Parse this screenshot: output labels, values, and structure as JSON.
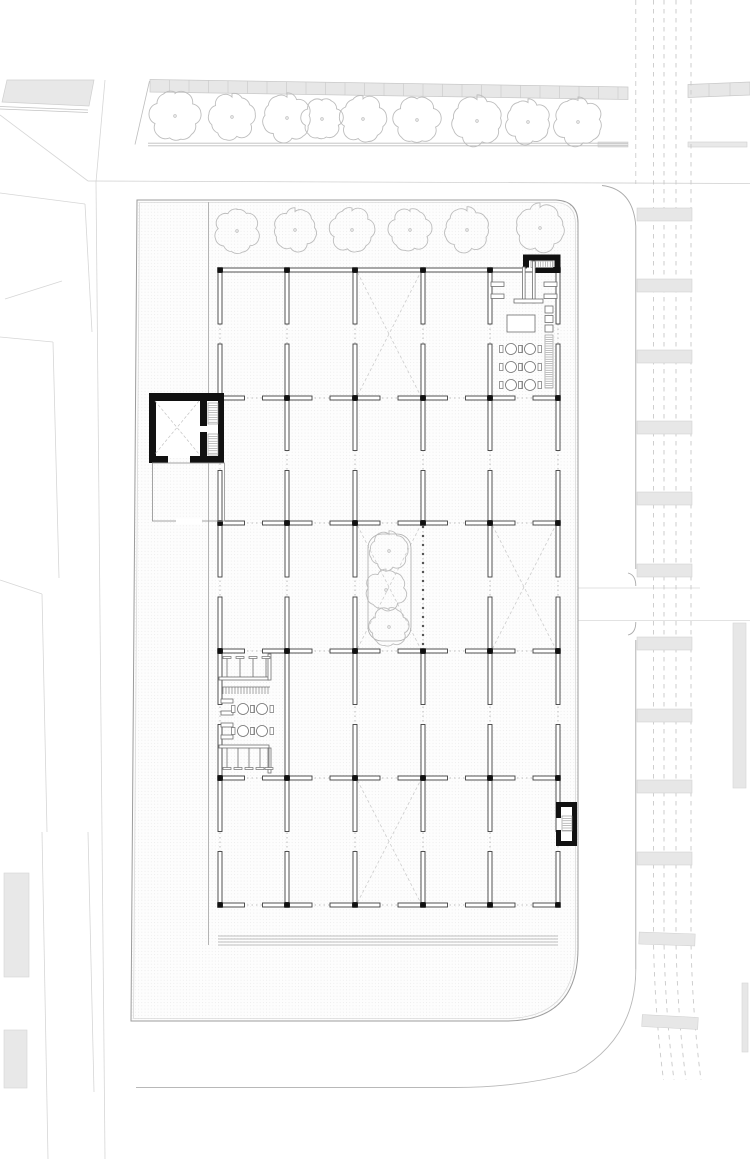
{
  "meta": {
    "title": "Architectural site plan - ground floor with column grid, stair cores and street context",
    "canvas": {
      "w": 750,
      "h": 1159
    }
  },
  "palette": {
    "paper": "#ffffff",
    "black_core": "#111111",
    "wall_stroke": "#3f3f3f",
    "furniture_stroke": "#6e6e6e",
    "tree_stroke": "#bdbdbd",
    "brace_stroke": "#cccccc",
    "dotted_grid": "#ababab",
    "terrace_stroke": "#9c9c9c",
    "terrace_inner": "#d9d9d9",
    "faint_street": "#d6d6d6",
    "road_edge": "#ababab",
    "lane_dash": "#c9c9c9",
    "block_fill": "#e8e8e8",
    "bar_fill": "#e7e7e7",
    "bar_stroke": "#d2d2d2",
    "stipple_dot": "#e6e6e6",
    "hatch_stroke": "#8a8a8a"
  },
  "plan": {
    "streets": {
      "faint_lines": [
        [
          0,
          115,
          88,
          181
        ],
        [
          105,
          80,
          96,
          182
        ],
        [
          0,
          193,
          85,
          204
        ],
        [
          96,
          182,
          105,
          1159
        ],
        [
          85,
          204,
          92,
          332
        ],
        [
          0,
          337,
          53,
          342
        ],
        [
          53,
          342,
          59,
          578
        ],
        [
          0,
          580,
          42,
          594
        ],
        [
          42,
          594,
          47,
          832
        ],
        [
          42,
          832,
          48,
          1159
        ],
        [
          88,
          832,
          94,
          1092
        ],
        [
          5,
          299,
          62,
          281
        ]
      ],
      "nw_block": {
        "pts": [
          [
            7,
            80
          ],
          [
            94,
            80
          ],
          [
            89,
            106
          ],
          [
            2,
            102
          ]
        ]
      },
      "nw_block_edge": [
        [
          0,
          106.5,
          88,
          110
        ],
        [
          0,
          109,
          88,
          112.5
        ]
      ],
      "west_rects": [
        {
          "x": 4,
          "y": 873,
          "w": 25,
          "h": 104
        },
        {
          "x": 4,
          "y": 1030,
          "w": 23,
          "h": 58
        }
      ],
      "north_line": [
        88,
        181,
        750,
        183.5
      ],
      "bands": [
        {
          "x1": 150,
          "y1": 79.5,
          "x2": 628,
          "y2": 87,
          "h": 12.5,
          "step": 19.5
        },
        {
          "x1": 688,
          "y1": 84.5,
          "x2": 750,
          "y2": 82,
          "h": 13,
          "step": 21
        }
      ],
      "thin_bars": [
        {
          "x": 598,
          "y": 142,
          "w": 30,
          "h": 5
        },
        {
          "x": 688,
          "y": 142,
          "w": 59,
          "h": 5
        }
      ],
      "tree_strip_bottom": [
        [
          148,
          143.2,
          628,
          143.2
        ],
        [
          148,
          145.8,
          628,
          145.8
        ]
      ],
      "tree_strip_left_edge": [
        149.5,
        81,
        135,
        144.5
      ]
    },
    "road": {
      "top_corner": "M602,185.5 Q633,189 635.8,226",
      "edge_segments": [
        [
          635.8,
          226,
          635.8,
          569
        ],
        [
          635.8,
          640,
          635.8,
          969
        ]
      ],
      "edge_dashed_top": [
        635.8,
        0,
        635.8,
        184
      ],
      "driveway_brackets": [
        "M628,573 Q635.8,575 635.8,586",
        "M628,635 Q635.8,633 635.8,622"
      ],
      "driveway_lines": [
        [
          578,
          588,
          700,
          588
        ],
        [
          578,
          620.5,
          750,
          620.5
        ]
      ],
      "outer_bottom": "M635.8,969 Q635.8,1038 576,1072 Q521,1087.5 455,1087.5 L136,1087.5",
      "lane_xs": [
        653.5,
        664,
        676,
        691
      ],
      "lane_path_suffix": " L0,943 Q1.5,1015 10,1080",
      "crosswalk": {
        "x": 637,
        "w": 55,
        "h": 13,
        "ys": [
          208,
          279,
          350,
          421,
          492,
          564,
          637,
          709,
          780,
          852
        ]
      },
      "crosswalk_tilted": [
        {
          "x": 639,
          "y": 933,
          "w": 56,
          "h": 12,
          "rot": 2,
          "cx": 667,
          "cy": 939
        },
        {
          "x": 642,
          "y": 1016,
          "w": 56,
          "h": 12,
          "rot": 3,
          "cx": 670,
          "cy": 1022
        }
      ],
      "right_strips": [
        {
          "x": 733,
          "y": 623,
          "w": 13,
          "h": 165
        },
        {
          "x": 742,
          "y": 983,
          "w": 6,
          "h": 69
        }
      ]
    },
    "site": {
      "parcel_path": "M137,200 L556,200 Q578,201 578,223 L578,948 Q578,1021 506,1021 L131,1021 Z",
      "parcel_inner_path": "M139.5,202.5 L555,202.5 Q575.5,203 575.5,224 L575.5,947 Q575.5,1018.5 505,1018.5 L133.5,1018.5 Z",
      "south_steps": [
        [
          218,
          936,
          558,
          936
        ],
        [
          218,
          939,
          558,
          939
        ],
        [
          218,
          942,
          558,
          942
        ],
        [
          218,
          945,
          558,
          945
        ]
      ],
      "canopy_line": [
        208.5,
        202,
        208.5,
        945
      ]
    },
    "trees": {
      "row_a": [
        [
          175,
          116,
          27
        ],
        [
          232,
          117,
          25
        ],
        [
          287,
          118,
          26
        ],
        [
          322,
          119,
          22
        ],
        [
          363,
          119,
          25
        ],
        [
          417,
          120,
          25
        ],
        [
          477,
          121,
          27
        ],
        [
          528,
          122,
          24
        ],
        [
          578,
          122,
          26
        ]
      ],
      "row_b": [
        [
          237,
          231,
          24
        ],
        [
          295,
          230,
          23
        ],
        [
          352,
          230,
          24
        ],
        [
          410,
          230,
          23
        ],
        [
          467,
          230,
          24
        ],
        [
          540,
          228,
          26
        ]
      ],
      "atrium": [
        [
          389,
          551,
          21
        ],
        [
          386,
          590,
          22
        ],
        [
          389,
          627,
          21
        ]
      ]
    },
    "building": {
      "cols": [
        220,
        287,
        355,
        423,
        490,
        558
      ],
      "rows": [
        270,
        398,
        523,
        651,
        778,
        905
      ],
      "wall_thickness": 4,
      "end_margin": 2.5,
      "gap_h": 18,
      "gap_v": 20,
      "column_size": 5.5,
      "top_row_solid": true,
      "solid_vertical": [
        {
          "c": 1,
          "r": 3
        }
      ],
      "open_vertical": [
        {
          "c": 3,
          "r": 2
        }
      ],
      "braces": [
        [
          357.5,
          272.5,
          420.5,
          395.5
        ],
        [
          357.5,
          525.5,
          420.5,
          648.5
        ],
        [
          492.5,
          525.5,
          555.5,
          648.5
        ],
        [
          357.5,
          780.5,
          420.5,
          902.5
        ]
      ],
      "tickline": {
        "x": 423,
        "y1": 527,
        "y2": 648,
        "step": 9
      },
      "planter": {
        "x": 368,
        "y": 534,
        "w": 43,
        "h": 107,
        "rx": 14
      }
    },
    "west_core": {
      "solids": [
        {
          "x": 149,
          "y": 393,
          "w": 75,
          "h": 8
        },
        {
          "x": 149,
          "y": 393,
          "w": 7,
          "h": 70
        },
        {
          "x": 149,
          "y": 456,
          "w": 19,
          "h": 7
        },
        {
          "x": 190,
          "y": 456,
          "w": 34,
          "h": 7
        },
        {
          "x": 200,
          "y": 398,
          "w": 7,
          "h": 28
        },
        {
          "x": 200,
          "y": 432,
          "w": 7,
          "h": 26
        },
        {
          "x": 218,
          "y": 393,
          "w": 6,
          "h": 70
        }
      ],
      "hatches": [
        {
          "x": 208,
          "y": 403,
          "w": 10,
          "h": 21,
          "step": 2.4,
          "dir": "h"
        },
        {
          "x": 208,
          "y": 434,
          "w": 10,
          "h": 21,
          "step": 2.4,
          "dir": "h"
        }
      ],
      "x_lines": [
        [
          155,
          401,
          199,
          454
        ],
        [
          199,
          401,
          155,
          454
        ]
      ],
      "room": {
        "x": 152.5,
        "y": 463,
        "w": 72,
        "h": 58
      },
      "room_door_gap": {
        "x": 176,
        "y": 518.5,
        "w": 26,
        "h": 6
      }
    },
    "ne_core": {
      "solids": [
        {
          "x": 523,
          "y": 254.5,
          "w": 37,
          "h": 6
        },
        {
          "x": 554.5,
          "y": 254.5,
          "w": 6,
          "h": 18
        },
        {
          "x": 533,
          "y": 267,
          "w": 27.5,
          "h": 6
        },
        {
          "x": 523,
          "y": 254.5,
          "w": 6,
          "h": 13
        }
      ],
      "hatch": {
        "x": 531,
        "y": 261,
        "w": 22,
        "h": 6.5,
        "step": 2.4,
        "dir": "v"
      },
      "corridor_walls": [
        {
          "x": 522.5,
          "y": 267,
          "w": 2.6,
          "h": 36
        },
        {
          "x": 532.5,
          "y": 261,
          "w": 2.6,
          "h": 42
        }
      ],
      "partition": {
        "x": 514,
        "y": 299,
        "w": 29,
        "h": 4
      }
    },
    "east_core": {
      "solids": [
        {
          "x": 556,
          "y": 802,
          "w": 21,
          "h": 5
        },
        {
          "x": 572,
          "y": 802,
          "w": 5,
          "h": 44
        },
        {
          "x": 556,
          "y": 841,
          "w": 21,
          "h": 5
        },
        {
          "x": 556,
          "y": 802,
          "w": 5,
          "h": 16
        },
        {
          "x": 556,
          "y": 830,
          "w": 5,
          "h": 16
        }
      ],
      "hatch": {
        "x": 562,
        "y": 816,
        "w": 10,
        "h": 15,
        "step": 2.4,
        "dir": "h"
      }
    },
    "cafe_furniture": {
      "wall_stubs": [
        {
          "x": 491,
          "y": 282,
          "w": 13,
          "h": 4.5
        },
        {
          "x": 491,
          "y": 294,
          "w": 13,
          "h": 4.5
        },
        {
          "x": 544,
          "y": 282,
          "w": 13,
          "h": 4.5
        },
        {
          "x": 544,
          "y": 294,
          "w": 13,
          "h": 4.5
        }
      ],
      "square_table": {
        "x": 507,
        "y": 315,
        "w": 28,
        "h": 17
      },
      "round_tables": [
        [
          511,
          349
        ],
        [
          530,
          349
        ],
        [
          511,
          367
        ],
        [
          530,
          367
        ],
        [
          511,
          385
        ],
        [
          530,
          385
        ]
      ],
      "table_radius": 5.5,
      "wall_boxes": [
        {
          "x": 545,
          "y": 306,
          "w": 8,
          "h": 7
        },
        {
          "x": 545,
          "y": 315.5,
          "w": 8,
          "h": 7
        },
        {
          "x": 545,
          "y": 325,
          "w": 8,
          "h": 7
        }
      ],
      "shelf_strip": {
        "x": 545,
        "y": 335,
        "w": 8,
        "h": 53,
        "step": 2.2,
        "dir": "h"
      }
    },
    "west_zone": {
      "top_counter": [
        {
          "x": 219,
          "y": 677,
          "w": 50,
          "h": 3
        },
        {
          "x": 268,
          "y": 654,
          "w": 3,
          "h": 26
        }
      ],
      "top_stools": {
        "xs": [
          227,
          240,
          253,
          266
        ],
        "y1": 658,
        "y2": 677,
        "bar": "top"
      },
      "comb": {
        "x1": 222,
        "x2": 270,
        "y": 687,
        "step": 3,
        "len": 7
      },
      "benches": [
        {
          "x": 221,
          "y": 699,
          "w": 12,
          "h": 4
        },
        {
          "x": 221,
          "y": 711,
          "w": 12,
          "h": 4
        },
        {
          "x": 221,
          "y": 723,
          "w": 12,
          "h": 4
        },
        {
          "x": 221,
          "y": 735,
          "w": 12,
          "h": 4
        }
      ],
      "round_tables": [
        [
          243,
          709
        ],
        [
          262,
          709
        ],
        [
          243,
          731
        ],
        [
          262,
          731
        ]
      ],
      "table_radius": 5.5,
      "bottom_counter": [
        {
          "x": 219,
          "y": 745,
          "w": 50,
          "h": 3
        },
        {
          "x": 268,
          "y": 748,
          "w": 3,
          "h": 25
        }
      ],
      "bottom_stools": {
        "xs": [
          227,
          238,
          249,
          260,
          269
        ],
        "y1": 748,
        "y2": 768,
        "bar": "bottom"
      }
    }
  }
}
